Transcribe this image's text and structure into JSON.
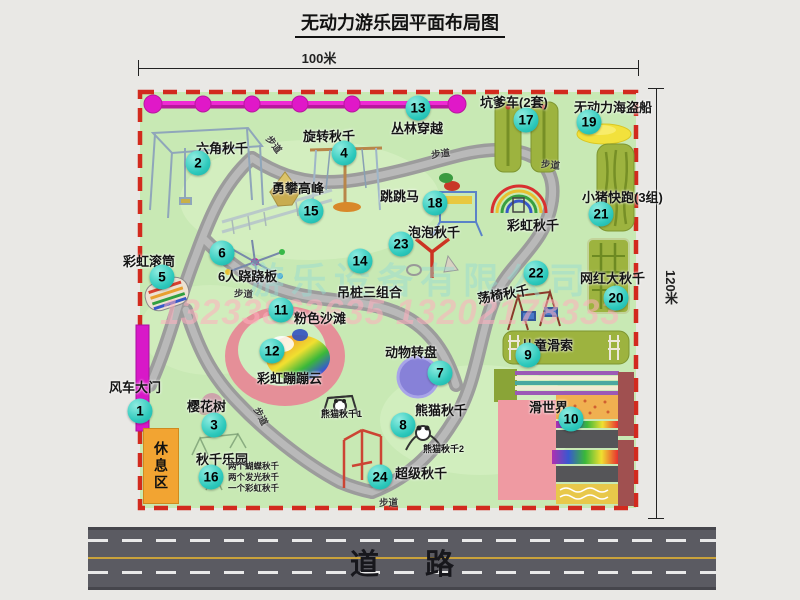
{
  "title": "无动力游乐园平面布局图",
  "dimensions": {
    "width": "100米",
    "height": "120米"
  },
  "road": {
    "label": "道路"
  },
  "rest_area": {
    "label": "休息区"
  },
  "watermark": {
    "company": "游乐设备有限公司",
    "phone": "13233863635 13202178333"
  },
  "labels": {
    "footpath": "步道",
    "rainbow_swing": "彩虹秋千",
    "panda_swing_1": "熊猫秋千1",
    "panda_swing_2": "熊猫秋千2"
  },
  "colors": {
    "park_green": "#c8e9b4",
    "border_red": "#d22a1e",
    "badge_teal": "#2dc9bc",
    "zipline_magenta": "#e018c8",
    "gate_magenta": "#d818c8",
    "rest_orange": "#f2a432",
    "road_gray": "#5b5b62"
  },
  "pois": [
    {
      "num": "1",
      "label": "风车大门"
    },
    {
      "num": "2",
      "label": "六角秋千"
    },
    {
      "num": "3",
      "label": "樱花树"
    },
    {
      "num": "4",
      "label": "旋转秋千"
    },
    {
      "num": "5",
      "label": "彩虹滚筒"
    },
    {
      "num": "6",
      "label": "6人跷跷板"
    },
    {
      "num": "7",
      "label": "动物转盘"
    },
    {
      "num": "8",
      "label": "熊猫秋千"
    },
    {
      "num": "9",
      "label": "儿童滑索"
    },
    {
      "num": "10",
      "label": "滑世界"
    },
    {
      "num": "11",
      "label": "粉色沙滩"
    },
    {
      "num": "12",
      "label": "彩虹蹦蹦云"
    },
    {
      "num": "13",
      "label": "丛林穿越"
    },
    {
      "num": "14",
      "label": "吊桩三组合"
    },
    {
      "num": "15",
      "label": "勇攀高峰"
    },
    {
      "num": "16",
      "label": "秋千乐园",
      "notes": [
        "两个蝴蝶秋千",
        "两个发光秋千",
        "一个彩虹秋千"
      ]
    },
    {
      "num": "17",
      "label": "坑爹车(2套)"
    },
    {
      "num": "18",
      "label": "跳跳马"
    },
    {
      "num": "19",
      "label": "无动力海盗船"
    },
    {
      "num": "20",
      "label": "网红大秋千"
    },
    {
      "num": "21",
      "label": "小猪快跑(3组)"
    },
    {
      "num": "22",
      "label": "荡椅秋千"
    },
    {
      "num": "23",
      "label": "泡泡秋千"
    },
    {
      "num": "24",
      "label": "超级秋千"
    }
  ]
}
